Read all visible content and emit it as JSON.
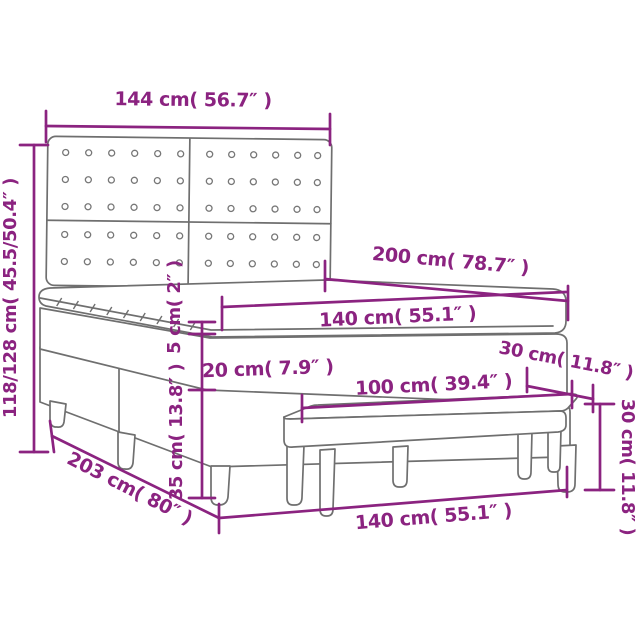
{
  "diagram": {
    "subject": "box-spring-bed-with-headboard-and-bench",
    "colors": {
      "dimension": "#8B2380",
      "outline": "#6F6F6F",
      "background": "#FFFFFF"
    },
    "labels": {
      "headboard_width": "144 cm( 56.7″ )",
      "total_height": "118/128 cm( 45.5/50.4″ )",
      "mattress_length": "200 cm( 78.7″ )",
      "mattress_width": "140 cm( 55.1″ )",
      "topper_thickness": "5 cm( 2″ )",
      "mattress_thickness": "20 cm( 7.9″ )",
      "bench_depth": "30 cm( 11.8″ )",
      "bench_length": "100 cm( 39.4″ )",
      "base_height": "35 cm( 13.8″ )",
      "bed_length": "203 cm( 80″ )",
      "base_width": "140 cm( 55.1″ )",
      "bench_height": "30 cm( 11.8″ )"
    }
  }
}
